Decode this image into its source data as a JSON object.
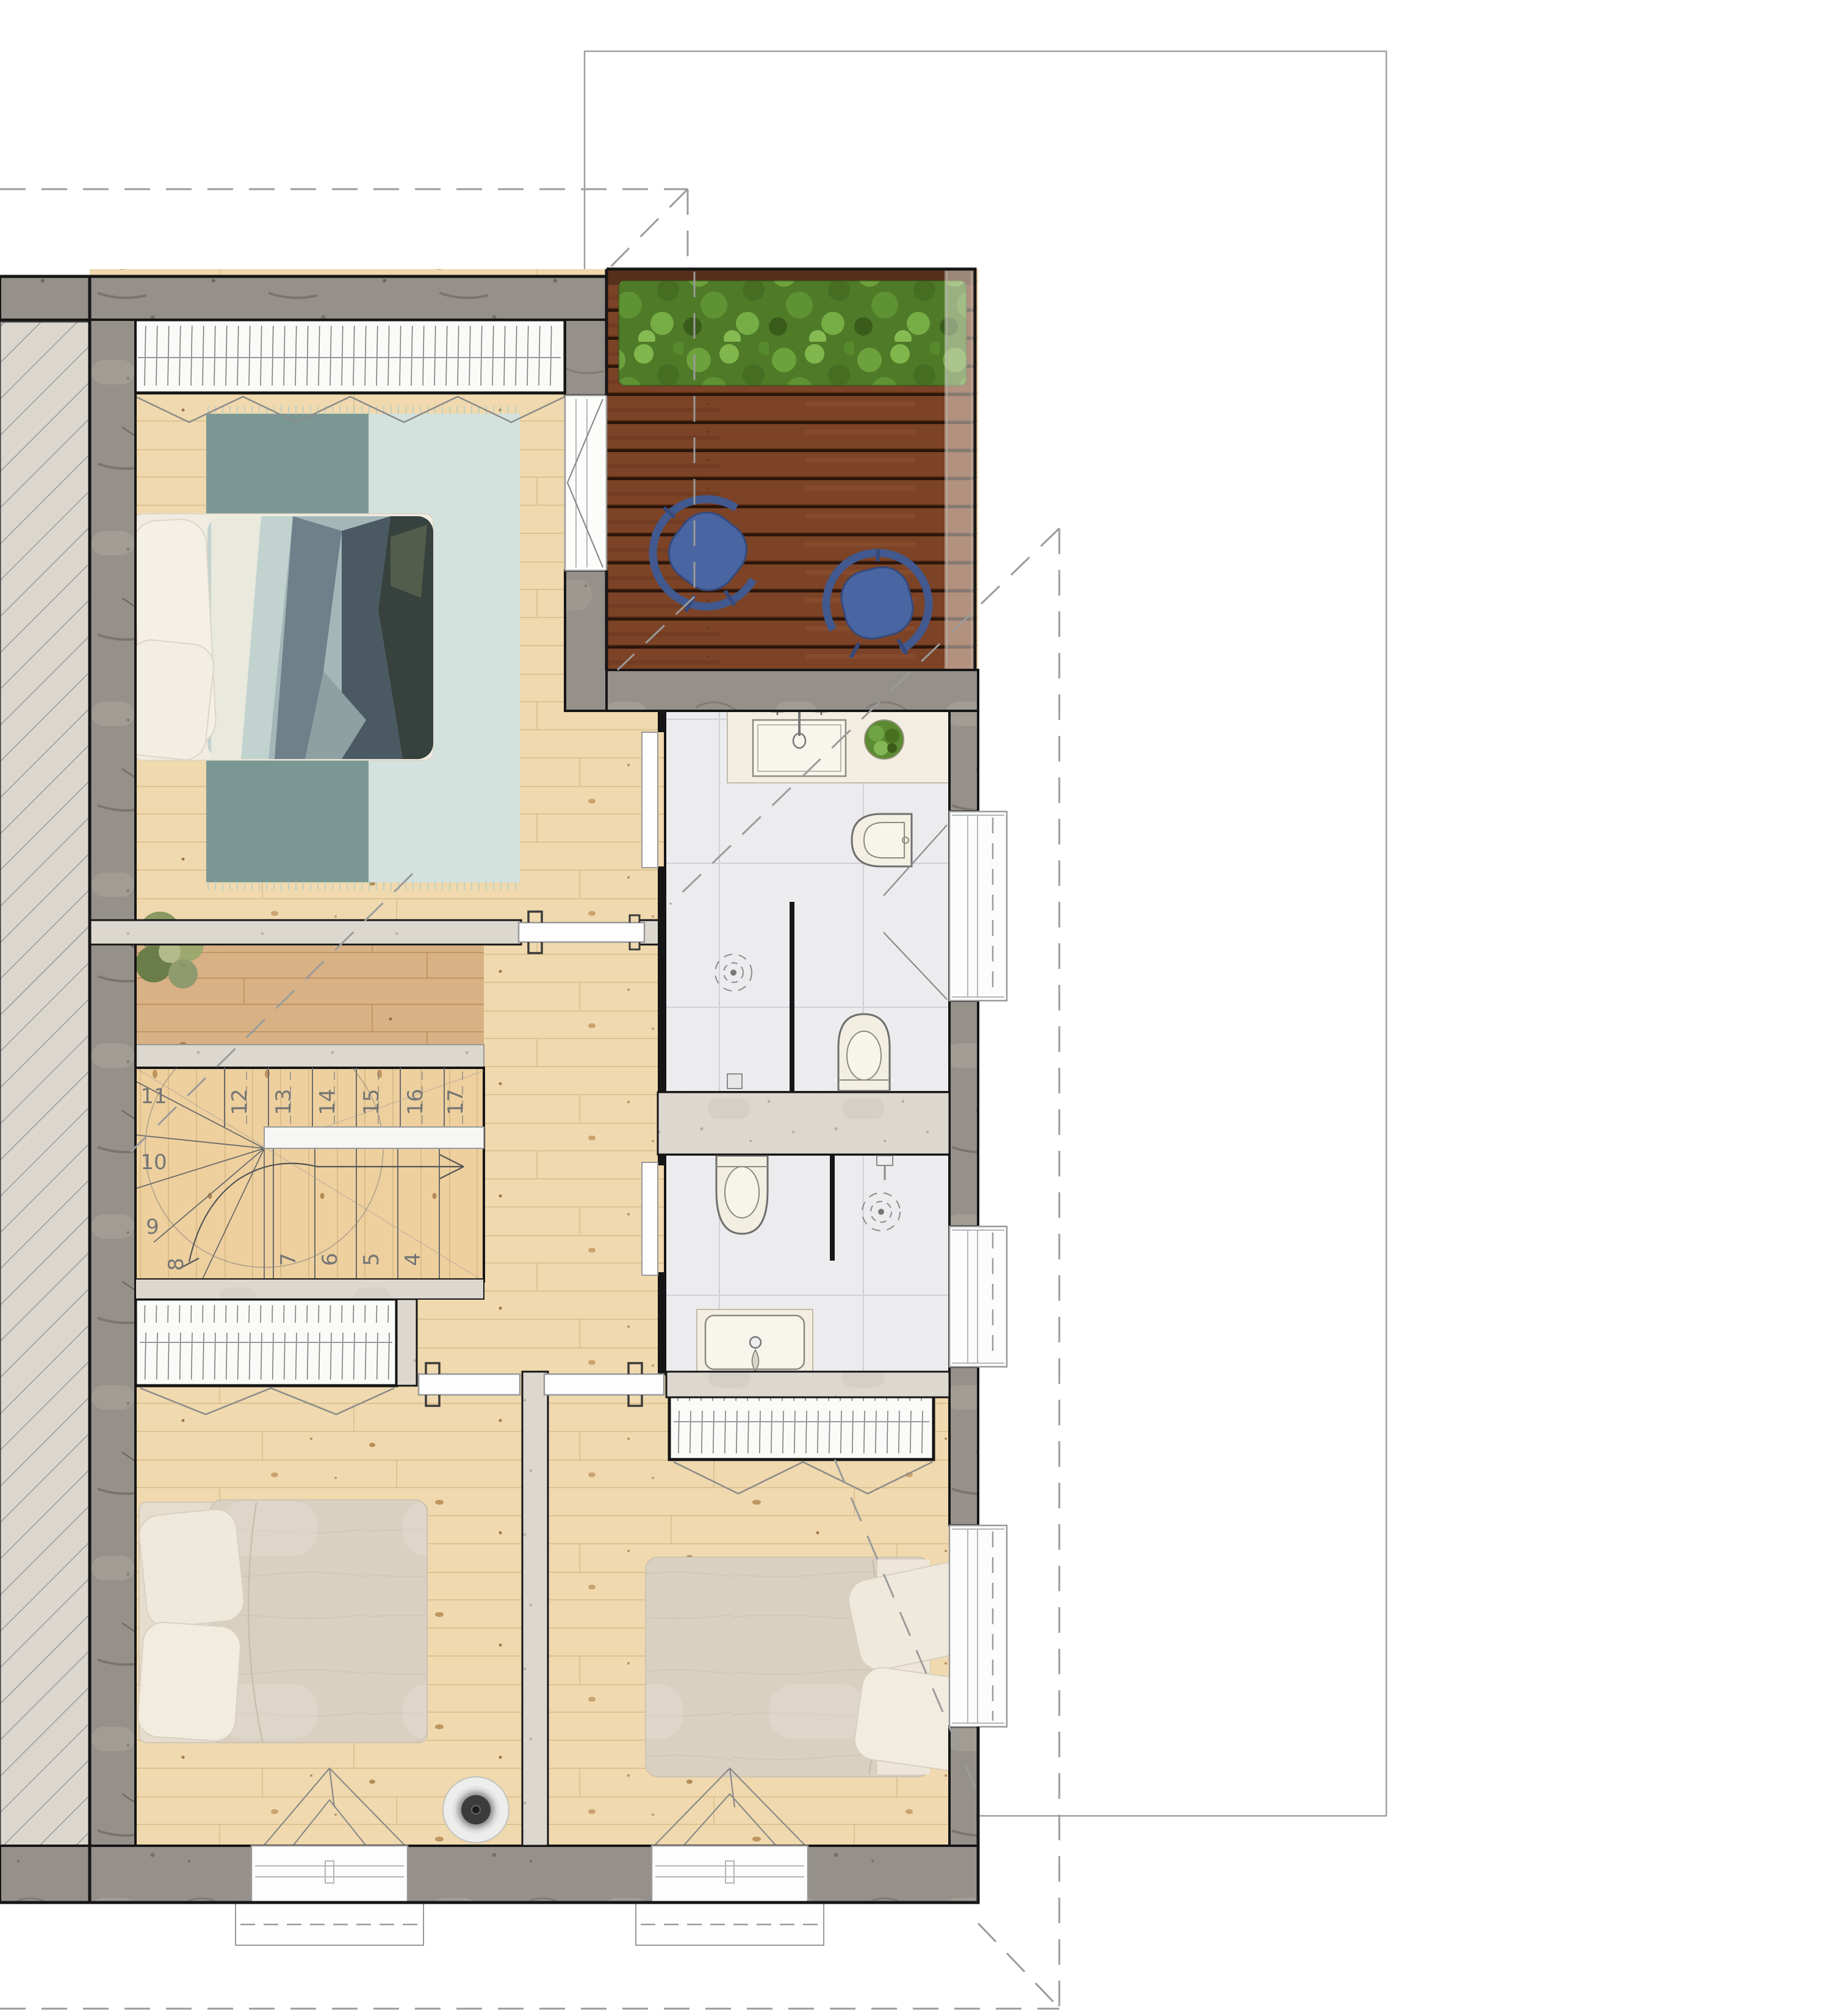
{
  "plan": {
    "type": "architectural-floor-plan",
    "stairs": {
      "upper_steps": [
        "12",
        "13",
        "14",
        "15",
        "16",
        "17"
      ],
      "winder_steps": [
        "11",
        "10",
        "9",
        "8"
      ],
      "lower_steps": [
        "7",
        "6",
        "5",
        "4"
      ]
    },
    "icons": [
      "hedge-planter",
      "lounge-chair",
      "double-bed",
      "pillow",
      "area-rug",
      "wardrobe-rail",
      "stair-walk-arrow",
      "toilet",
      "bidet",
      "vanity-sink",
      "shower-head",
      "floor-drain",
      "potted-plant",
      "ceiling-speaker",
      "window",
      "sliding-door",
      "hinged-door",
      "glass-partition",
      "roof-outline-dashed",
      "property-outline"
    ],
    "colors": {
      "deck_wood": "#7c4326",
      "hedge_green": "#4f7a28",
      "chair_blue": "#4a66a2",
      "rug_dark_teal": "#7b9793",
      "rug_light_mint": "#d3e2dd",
      "floor_wood": "#f0d9ae",
      "landing_wood": "#d8b184",
      "concrete_wall": "#95908a",
      "light_wall": "#dcd8d0",
      "tile_floor": "#ececef",
      "hatch_fill": "#dbd6ce",
      "duvet_beige": "#d9d0c2",
      "duvet_slate": "#4b5a62",
      "dash_gray": "#9b9b9b",
      "outline_black": "#161616"
    }
  }
}
